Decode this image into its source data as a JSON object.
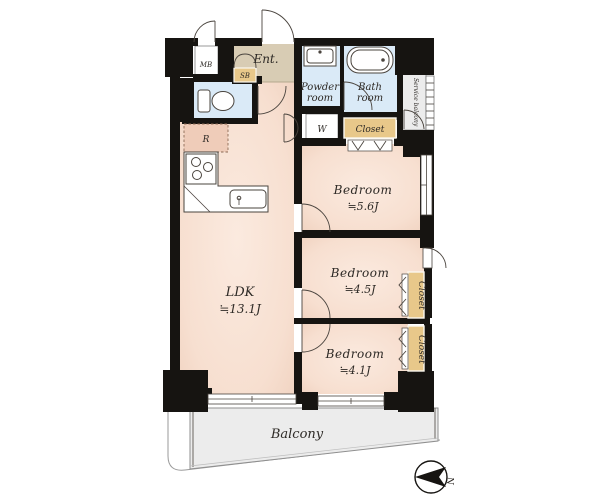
{
  "floor_plan": {
    "type": "apartment-floor-plan",
    "rooms": {
      "ldk": {
        "label": "LDK",
        "size": "≒13.1J"
      },
      "bedroom_main": {
        "label": "Bedroom",
        "size": "≒5.6J"
      },
      "bedroom_mid": {
        "label": "Bedroom",
        "size": "≒4.5J"
      },
      "bedroom_small": {
        "label": "Bedroom",
        "size": "≒4.1J"
      },
      "entrance": {
        "label": "Ent."
      },
      "powder_room": {
        "line1": "Powder",
        "line2": "room"
      },
      "bath_room": {
        "line1": "Bath",
        "line2": "room"
      },
      "balcony": {
        "label": "Balcony"
      },
      "service_balcony": {
        "label": "Service balcony"
      }
    },
    "fixtures": {
      "meter_box": "MB",
      "shoe_box": "SB",
      "washing_machine": "W",
      "refrigerator": "R",
      "closet_top": "Closet",
      "closet_mid": "Closet",
      "closet_small": "Closet"
    },
    "compass": {
      "north": "N"
    },
    "colors": {
      "wall": "#161411",
      "room_floor": "#f7dfd0",
      "entrance_floor": "#d8ccb4",
      "wet_area": "#daeaf7",
      "closet": "#e8c88a",
      "balcony": "#ececec"
    }
  }
}
